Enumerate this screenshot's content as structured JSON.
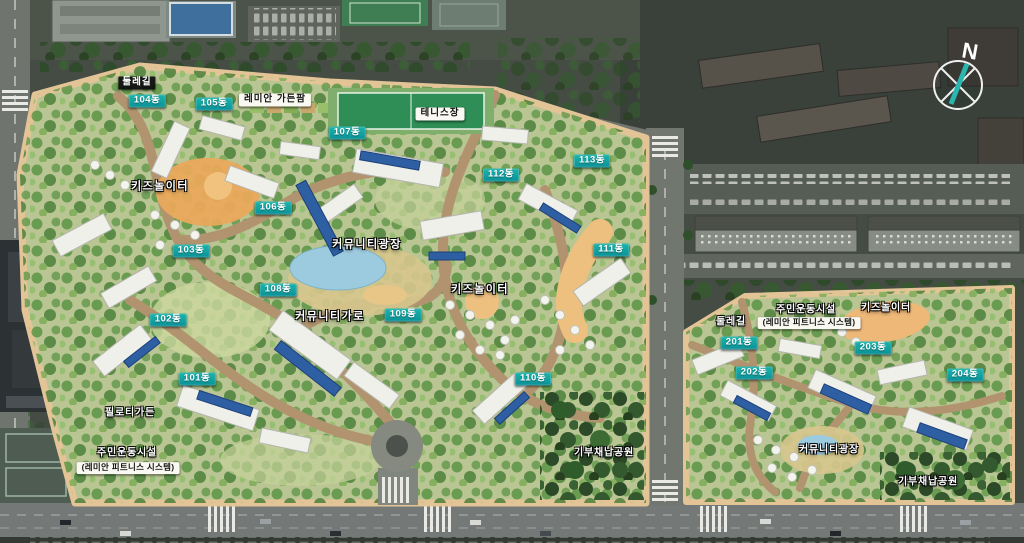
{
  "badges": [
    {
      "id": "101",
      "label": "101동"
    },
    {
      "id": "102",
      "label": "102동"
    },
    {
      "id": "103",
      "label": "103동"
    },
    {
      "id": "104",
      "label": "104동"
    },
    {
      "id": "105",
      "label": "105동"
    },
    {
      "id": "106",
      "label": "106동"
    },
    {
      "id": "107",
      "label": "107동"
    },
    {
      "id": "108",
      "label": "108동"
    },
    {
      "id": "109",
      "label": "109동"
    },
    {
      "id": "110",
      "label": "110동"
    },
    {
      "id": "111",
      "label": "111동"
    },
    {
      "id": "112",
      "label": "112동"
    },
    {
      "id": "113",
      "label": "113동"
    },
    {
      "id": "201",
      "label": "201동"
    },
    {
      "id": "202",
      "label": "202동"
    },
    {
      "id": "203",
      "label": "203동"
    },
    {
      "id": "204",
      "label": "204동"
    }
  ],
  "places": {
    "trail": "둘레길",
    "garden_farm": "레미안 가든팜",
    "tennis_court": "테니스장",
    "kids_playground": "키즈놀이터",
    "community_plaza": "커뮤니티광장",
    "community_street": "커뮤니티가로",
    "piloti_garden": "필로티가든",
    "residents_sports_facility": "주민운동시설",
    "fitness_system": "(레미안 피트니스 시스템)",
    "donated_park": "기부채납공원"
  },
  "compass": {
    "north": "N"
  },
  "colors": {
    "badge_teal": "#0fa2a1",
    "path_tan": "#e2c497",
    "road_tan": "#b1946f",
    "solar_panel_blue": "#2e5fa3",
    "complex_green": "#b9c593",
    "aerial_dark": "#454c44",
    "pond_blue": "#9ccadf"
  }
}
